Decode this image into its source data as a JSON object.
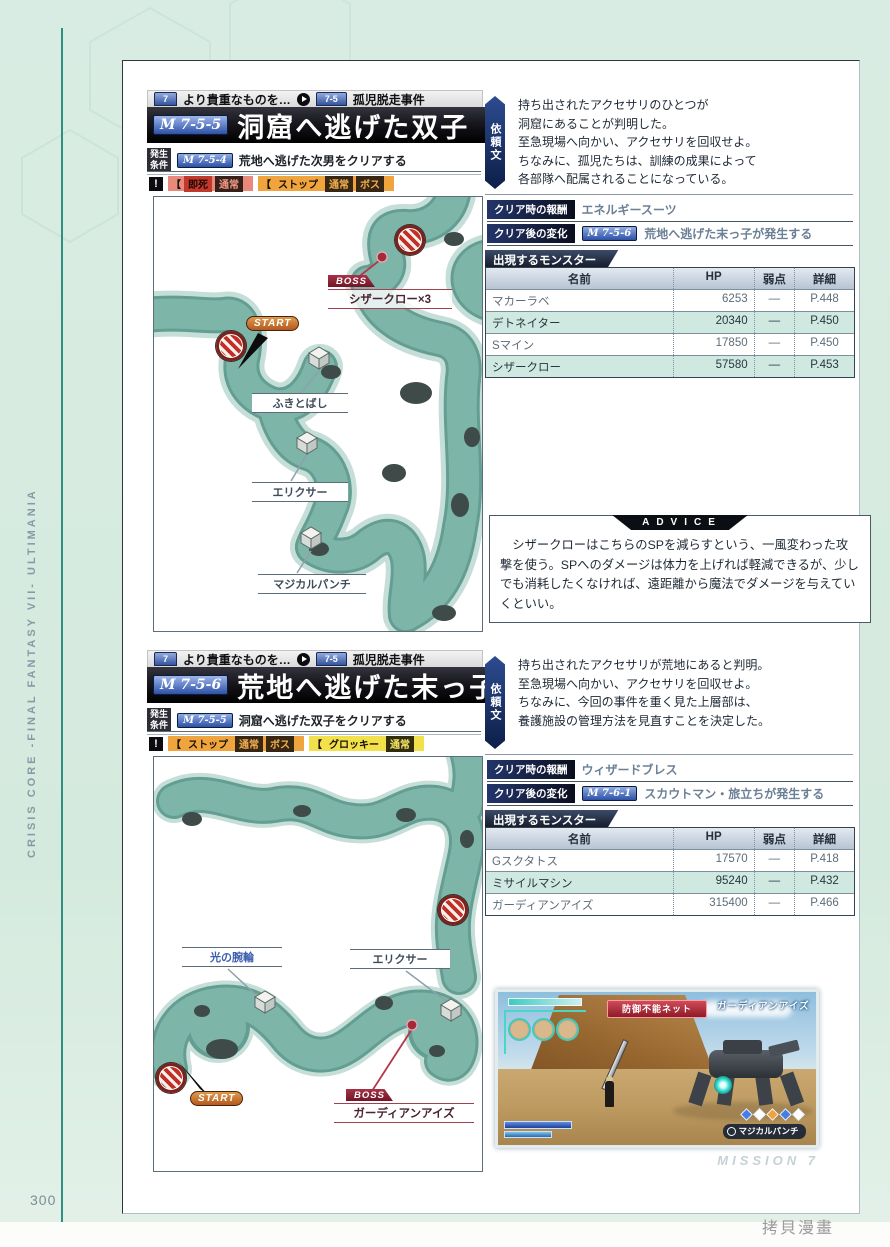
{
  "page": {
    "number": "300",
    "side_title": "CRISIS CORE -FINAL FANTASY VII- ULTIMANIA",
    "watermark": "拷貝漫畫",
    "footer_watermark": "MISSION 7"
  },
  "m1": {
    "chapter_num": "7",
    "chapter_title": "より貴重なものを…",
    "section_num": "7-5",
    "section_title": "孤児脱走事件",
    "id": "M 7-5-5",
    "title": "洞窟へ逃げた双子",
    "cond_label_1": "発生",
    "cond_label_2": "条件",
    "cond_badge": "M 7-5-4",
    "cond_text": "荒地へ逃げた次男をクリアする",
    "warn": "!",
    "status": {
      "g1": {
        "bracket": "【",
        "b1": "即死",
        "b2": "通常"
      },
      "g2": {
        "bracket": "【",
        "b1": "ストップ",
        "b2": "通常",
        "b3": "ボス"
      }
    },
    "request_label": "依頼文",
    "request_text": "持ち出されたアクセサリのひとつが\n洞窟にあることが判明した。\n至急現場へ向かい、アクセサリを回収せよ。\nちなみに、孤児たちは、訓練の成果によって\n各部隊へ配属されることになっている。",
    "reward_label": "クリア時の報酬",
    "reward_value": "エネルギースーツ",
    "change_label": "クリア後の変化",
    "change_badge": "M 7-5-6",
    "change_text": "荒地へ逃げた末っ子が発生する",
    "monsters_label": "出現するモンスター",
    "mh": {
      "name": "名前",
      "hp": "HP",
      "weak": "弱点",
      "detail": "詳細"
    },
    "monsters": [
      {
        "name": "マカーラベ",
        "hp": "6253",
        "weak": "—",
        "detail": "P.448"
      },
      {
        "name": "デトネイター",
        "hp": "20340",
        "weak": "—",
        "detail": "P.450"
      },
      {
        "name": "Sマイン",
        "hp": "17850",
        "weak": "—",
        "detail": "P.450"
      },
      {
        "name": "シザークロー",
        "hp": "57580",
        "weak": "—",
        "detail": "P.453"
      }
    ],
    "advice_label": "ADVICE",
    "advice_text": "　シザークローはこちらのSPを減らすという、一風変わった攻撃を使う。SPへのダメージは体力を上げれば軽減できるが、少しでも消耗したくなければ、遠距離から魔法でダメージを与えていくといい。",
    "map": {
      "start": "START",
      "boss_tag": "BOSS",
      "boss_name": "シザークロー×3",
      "item1": "ふきとばし",
      "item2": "エリクサー",
      "item3": "マジカルパンチ"
    }
  },
  "m2": {
    "chapter_num": "7",
    "chapter_title": "より貴重なものを…",
    "section_num": "7-5",
    "section_title": "孤児脱走事件",
    "id": "M 7-5-6",
    "title": "荒地へ逃げた末っ子",
    "cond_label_1": "発生",
    "cond_label_2": "条件",
    "cond_badge": "M 7-5-5",
    "cond_text": "洞窟へ逃げた双子をクリアする",
    "warn": "!",
    "status": {
      "g1": {
        "bracket": "【",
        "b1": "ストップ",
        "b2": "通常",
        "b3": "ボス"
      },
      "g2": {
        "bracket": "【",
        "b1": "グロッキー",
        "b2": "通常"
      }
    },
    "request_label": "依頼文",
    "request_text": "持ち出されたアクセサリが荒地にあると判明。\n至急現場へ向かい、アクセサリを回収せよ。\nちなみに、今回の事件を重く見た上層部は、\n養護施設の管理方法を見直すことを決定した。",
    "reward_label": "クリア時の報酬",
    "reward_value": "ウィザードブレス",
    "change_label": "クリア後の変化",
    "change_badge": "M 7-6-1",
    "change_text": "スカウトマン・旅立ちが発生する",
    "monsters_label": "出現するモンスター",
    "mh": {
      "name": "名前",
      "hp": "HP",
      "weak": "弱点",
      "detail": "詳細"
    },
    "monsters": [
      {
        "name": "Gスクタトス",
        "hp": "17570",
        "weak": "—",
        "detail": "P.418"
      },
      {
        "name": "ミサイルマシン",
        "hp": "95240",
        "weak": "—",
        "detail": "P.432"
      },
      {
        "name": "ガーディアンアイズ",
        "hp": "315400",
        "weak": "—",
        "detail": "P.466"
      }
    ],
    "map": {
      "start": "START",
      "boss_tag": "BOSS",
      "boss_name": "ガーディアンアイズ",
      "item1": "光の腕輪",
      "item2": "エリクサー"
    },
    "screenshot": {
      "banner": "防御不能ネット",
      "enemy_name": "ガーディアンアイズ",
      "command": "マジカルパンチ"
    }
  }
}
